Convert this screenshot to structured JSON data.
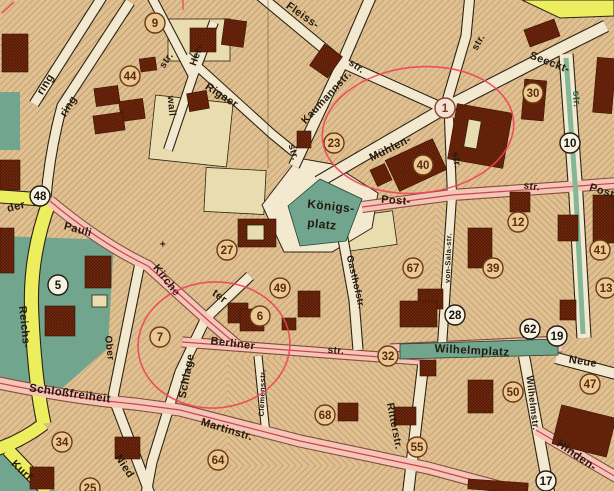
{
  "title": "Historical city map section with circled numbers and red ellipse annotations",
  "map": {
    "size": [
      614,
      491
    ],
    "palette": {
      "block": "#dfc092",
      "hatch": "#ad7b42",
      "ink": "#241a0e",
      "roadCream": "#f3e8d0",
      "roadCasing": "#2b2315",
      "roadPink": "#f2c6b8",
      "pinkCasing": "#8a4a3a",
      "redline": "#cf4348",
      "roadYellow": "#edee5f",
      "park": "#72a58d",
      "parkLine": "#1f4435",
      "median": "#84b795",
      "cream": "#e9dcae",
      "bld": "#7b2d11",
      "bldline": "#4e1703",
      "bldStroke": "#3a1403",
      "anno": "#ee4256",
      "greenText": "#1d5c3c",
      "foldLine": "#41351f"
    },
    "hatch2_zones": [
      {
        "x": 436,
        "y": 190,
        "w": 140,
        "h": 150
      },
      {
        "x": 228,
        "y": 358,
        "w": 202,
        "h": 108
      }
    ],
    "teal_early": [
      {
        "pts": "0,236 114,240 108,348 58,392 0,384"
      },
      {
        "pts": "0,92 20,92 20,150 0,150"
      },
      {
        "pts": "0,449 56,491 0,491"
      }
    ],
    "khaki": [
      {
        "x": 168,
        "y": 19,
        "w": 62,
        "h": 42,
        "rot": 0
      },
      {
        "x": 152,
        "y": 99,
        "w": 78,
        "h": 64,
        "rot": 6
      },
      {
        "x": 205,
        "y": 169,
        "w": 60,
        "h": 44,
        "rot": 3
      },
      {
        "x": 345,
        "y": 214,
        "w": 50,
        "h": 34,
        "rot": -8
      }
    ],
    "platz_poly": "262,205 298,158 332,164 378,193 372,228 332,252 284,252",
    "roads": [
      {
        "d": "M104,-6 L34,104",
        "w": 9,
        "k": "c"
      },
      {
        "d": "M130,2 L62,106 Q50,150 46,197",
        "w": 9,
        "k": "c"
      },
      {
        "d": "M150,-6 L193,76",
        "w": 8,
        "k": "c"
      },
      {
        "d": "M214,22 L193,76 L168,150",
        "w": 8,
        "k": "c"
      },
      {
        "d": "M186,56 L272,134 L294,152",
        "w": 8,
        "k": "c"
      },
      {
        "d": "M294,166 L340,68 L372,-6",
        "w": 10,
        "k": "c"
      },
      {
        "d": "M258,-6 L340,62 L445,109",
        "w": 9,
        "k": "c"
      },
      {
        "d": "M318,182 L445,108 L558,50 L606,26",
        "w": 11,
        "k": "c"
      },
      {
        "d": "M445,108 L466,36 L470,-6",
        "w": 9,
        "k": "c"
      },
      {
        "d": "M449,118 L452,196 L442,346",
        "w": 8,
        "k": "c"
      },
      {
        "d": "M566,54 L576,196 L584,338",
        "w": 13,
        "k": "c"
      },
      {
        "d": "M342,233 L354,300 L358,350",
        "w": 9,
        "k": "c"
      },
      {
        "d": "M250,276 L206,318 L180,372 L152,462 L146,494",
        "w": 9,
        "k": "c"
      },
      {
        "d": "M141,258 L113,397 L150,494",
        "w": 9,
        "k": "c"
      },
      {
        "d": "M258,356 L266,434",
        "w": 7,
        "k": "c"
      },
      {
        "d": "M424,358 L408,494",
        "w": 10,
        "k": "c"
      },
      {
        "d": "M524,356 L549,492",
        "w": 10,
        "k": "c"
      },
      {
        "d": "M556,358 L616,374",
        "w": 10,
        "k": "c"
      },
      {
        "d": "M-6,196 L50,200",
        "w": 12,
        "k": "y"
      },
      {
        "d": "M50,200 Q28,258 32,318 Q35,382 44,424",
        "w": 13,
        "k": "y"
      },
      {
        "d": "M44,424 Q20,442 -6,450",
        "w": 12,
        "k": "y"
      },
      {
        "d": "M8,450 L48,492",
        "w": 12,
        "k": "y"
      },
      {
        "d": "M362,207 L452,195 L566,187 L618,183",
        "w": 10,
        "k": "p"
      },
      {
        "d": "M50,201 Q100,243 148,266 L210,322 L238,346",
        "w": 10,
        "k": "p"
      },
      {
        "d": "M182,342 L340,354 L434,361",
        "w": 9,
        "k": "p"
      },
      {
        "d": "M-6,382 Q70,398 135,404 L180,410 L300,441 L428,468 L525,494",
        "w": 11,
        "k": "p"
      },
      {
        "d": "M536,430 L618,478",
        "w": 10,
        "k": "p"
      },
      {
        "d": "M390,352 L562,344",
        "w": 15,
        "k": "p"
      }
    ],
    "median": {
      "d": "M566,58 L576,196 L583,334",
      "w": 5
    },
    "teal_late": [
      {
        "pts": "288,206 320,179 362,199 346,241 300,246"
      },
      {
        "pts": "400,344 558,339 558,355 400,359"
      }
    ],
    "buildings": [
      {
        "x": 2,
        "y": 34,
        "w": 26,
        "h": 38,
        "rot": 0,
        "kind": "d"
      },
      {
        "x": 0,
        "y": 160,
        "w": 20,
        "h": 30,
        "rot": 0,
        "kind": "d"
      },
      {
        "x": 0,
        "y": 228,
        "w": 14,
        "h": 45,
        "rot": 0,
        "kind": "d"
      },
      {
        "x": 95,
        "y": 87,
        "w": 24,
        "h": 18,
        "rot": -8,
        "kind": "d"
      },
      {
        "x": 120,
        "y": 100,
        "w": 24,
        "h": 20,
        "rot": -8,
        "kind": "d"
      },
      {
        "x": 94,
        "y": 114,
        "w": 30,
        "h": 18,
        "rot": -8,
        "kind": "d"
      },
      {
        "x": 140,
        "y": 58,
        "w": 16,
        "h": 13,
        "rot": -8,
        "kind": "d"
      },
      {
        "x": 190,
        "y": 28,
        "w": 26,
        "h": 24,
        "rot": 0,
        "kind": "d"
      },
      {
        "x": 223,
        "y": 20,
        "w": 22,
        "h": 26,
        "rot": 8,
        "kind": "d"
      },
      {
        "x": 188,
        "y": 92,
        "w": 20,
        "h": 18,
        "rot": -10,
        "kind": "d"
      },
      {
        "x": 315,
        "y": 48,
        "w": 22,
        "h": 26,
        "rot": 35,
        "kind": "d"
      },
      {
        "x": 526,
        "y": 24,
        "w": 32,
        "h": 18,
        "rot": -20,
        "kind": "d"
      },
      {
        "x": 595,
        "y": 58,
        "w": 19,
        "h": 55,
        "rot": 5,
        "kind": "d"
      },
      {
        "x": 523,
        "y": 80,
        "w": 22,
        "h": 40,
        "rot": 5,
        "kind": "d"
      },
      {
        "x": 452,
        "y": 108,
        "w": 56,
        "h": 56,
        "rot": 10,
        "kind": "d"
      },
      {
        "x": 466,
        "y": 120,
        "w": 13,
        "h": 28,
        "rot": 10,
        "kind": "c"
      },
      {
        "x": 390,
        "y": 148,
        "w": 52,
        "h": 34,
        "rot": -25,
        "kind": "d"
      },
      {
        "x": 373,
        "y": 166,
        "w": 16,
        "h": 18,
        "rot": -25,
        "kind": "d"
      },
      {
        "x": 297,
        "y": 131,
        "w": 14,
        "h": 17,
        "rot": 0,
        "kind": "d"
      },
      {
        "x": 510,
        "y": 192,
        "w": 20,
        "h": 20,
        "rot": 0,
        "kind": "d"
      },
      {
        "x": 558,
        "y": 215,
        "w": 20,
        "h": 26,
        "rot": 0,
        "kind": "d"
      },
      {
        "x": 468,
        "y": 228,
        "w": 24,
        "h": 40,
        "rot": 0,
        "kind": "d"
      },
      {
        "x": 593,
        "y": 195,
        "w": 21,
        "h": 48,
        "rot": 0,
        "kind": "d"
      },
      {
        "x": 418,
        "y": 289,
        "w": 25,
        "h": 20,
        "rot": 0,
        "kind": "d"
      },
      {
        "x": 400,
        "y": 301,
        "w": 37,
        "h": 26,
        "rot": 0,
        "kind": "d"
      },
      {
        "x": 560,
        "y": 300,
        "w": 16,
        "h": 20,
        "rot": 0,
        "kind": "d"
      },
      {
        "x": 85,
        "y": 256,
        "w": 26,
        "h": 32,
        "rot": 0,
        "kind": "d"
      },
      {
        "x": 45,
        "y": 306,
        "w": 30,
        "h": 30,
        "rot": 0,
        "kind": "d"
      },
      {
        "x": 92,
        "y": 295,
        "w": 15,
        "h": 12,
        "rot": 0,
        "kind": "c"
      },
      {
        "x": 238,
        "y": 219,
        "w": 38,
        "h": 28,
        "rot": 0,
        "kind": "d"
      },
      {
        "x": 247,
        "y": 225,
        "w": 17,
        "h": 15,
        "rot": 0,
        "kind": "c"
      },
      {
        "x": 228,
        "y": 303,
        "w": 20,
        "h": 20,
        "rot": 0,
        "kind": "d"
      },
      {
        "x": 240,
        "y": 309,
        "w": 24,
        "h": 22,
        "rot": 0,
        "kind": "d"
      },
      {
        "x": 282,
        "y": 318,
        "w": 14,
        "h": 12,
        "rot": 0,
        "kind": "d"
      },
      {
        "x": 298,
        "y": 291,
        "w": 22,
        "h": 26,
        "rot": 0,
        "kind": "d"
      },
      {
        "x": 556,
        "y": 411,
        "w": 56,
        "h": 40,
        "rot": 14,
        "kind": "d"
      },
      {
        "x": 468,
        "y": 380,
        "w": 25,
        "h": 33,
        "rot": 0,
        "kind": "d"
      },
      {
        "x": 420,
        "y": 360,
        "w": 16,
        "h": 16,
        "rot": 0,
        "kind": "d"
      },
      {
        "x": 394,
        "y": 407,
        "w": 22,
        "h": 18,
        "rot": 0,
        "kind": "d"
      },
      {
        "x": 30,
        "y": 467,
        "w": 24,
        "h": 22,
        "rot": 0,
        "kind": "d"
      },
      {
        "x": 115,
        "y": 437,
        "w": 25,
        "h": 22,
        "rot": 0,
        "kind": "d"
      },
      {
        "x": 338,
        "y": 403,
        "w": 20,
        "h": 18,
        "rot": 0,
        "kind": "d"
      },
      {
        "x": 468,
        "y": 481,
        "w": 60,
        "h": 10,
        "rot": 4,
        "kind": "d"
      }
    ],
    "fold_line": {
      "x": 268,
      "y1": 0,
      "y2": 168
    },
    "labels": [
      {
        "t": "ring",
        "x": 45,
        "y": 84,
        "r": -58
      },
      {
        "t": "ring",
        "x": 68,
        "y": 106,
        "r": -58
      },
      {
        "t": "str.",
        "x": 166,
        "y": 60,
        "r": -55,
        "s": 10
      },
      {
        "t": "Her-",
        "x": 196,
        "y": 55,
        "r": -70,
        "s": 10
      },
      {
        "t": "wall",
        "x": 172,
        "y": 106,
        "r": 85,
        "s": 10
      },
      {
        "t": "Rigaer",
        "x": 222,
        "y": 95,
        "r": 33
      },
      {
        "t": "Fleiss-",
        "x": 303,
        "y": 15,
        "r": 35
      },
      {
        "t": "str.",
        "x": 357,
        "y": 66,
        "r": 35,
        "s": 10
      },
      {
        "t": "Kaumannstr.",
        "x": 326,
        "y": 97,
        "r": -47,
        "s": 10.5
      },
      {
        "t": "str.",
        "x": 478,
        "y": 42,
        "r": -60,
        "s": 10
      },
      {
        "t": "Seeckt-",
        "x": 550,
        "y": 62,
        "r": 21
      },
      {
        "t": "str.",
        "x": 577,
        "y": 99,
        "r": 87,
        "s": 10,
        "c": "#1d5c3c"
      },
      {
        "t": "str.",
        "x": 294,
        "y": 152,
        "r": 75,
        "s": 10
      },
      {
        "t": "Mühlen-",
        "x": 390,
        "y": 148,
        "r": -26
      },
      {
        "t": "str.",
        "x": 457,
        "y": 160,
        "r": 80,
        "s": 10
      },
      {
        "t": "Königs-",
        "x": 331,
        "y": 206,
        "r": 6,
        "s": 12
      },
      {
        "t": "platz",
        "x": 322,
        "y": 224,
        "r": 6,
        "s": 12
      },
      {
        "t": "Post-",
        "x": 396,
        "y": 200,
        "r": 4
      },
      {
        "t": "str.",
        "x": 532,
        "y": 186,
        "r": 8,
        "s": 10
      },
      {
        "t": "Post-",
        "x": 604,
        "y": 191,
        "r": 18
      },
      {
        "t": "der",
        "x": 16,
        "y": 206,
        "r": -14
      },
      {
        "t": "Pauli",
        "x": 78,
        "y": 229,
        "r": 15
      },
      {
        "t": "Kirche",
        "x": 167,
        "y": 280,
        "r": 52
      },
      {
        "t": "ter",
        "x": 220,
        "y": 296,
        "r": 36
      },
      {
        "t": "Reichs-",
        "x": 25,
        "y": 327,
        "r": 84
      },
      {
        "t": "Ober",
        "x": 110,
        "y": 348,
        "r": 83,
        "s": 10
      },
      {
        "t": "Gasthofstr.",
        "x": 356,
        "y": 282,
        "r": 77,
        "s": 9.5
      },
      {
        "t": "Berliner",
        "x": 233,
        "y": 343,
        "r": 7
      },
      {
        "t": "str.",
        "x": 336,
        "y": 350,
        "r": 4,
        "s": 10
      },
      {
        "t": "Schlage",
        "x": 186,
        "y": 376,
        "r": -79
      },
      {
        "t": "Schloßfreiheit",
        "x": 70,
        "y": 393,
        "r": 8,
        "s": 11.5
      },
      {
        "t": "Martinstr.",
        "x": 227,
        "y": 429,
        "r": 17
      },
      {
        "t": "Clemensstr.",
        "x": 262,
        "y": 393,
        "r": -88,
        "s": 7.5
      },
      {
        "t": "von-Sala-str.",
        "x": 448,
        "y": 258,
        "r": -88,
        "s": 7.5
      },
      {
        "t": "Nied",
        "x": 125,
        "y": 466,
        "r": 57
      },
      {
        "t": "Kurf",
        "x": 22,
        "y": 470,
        "r": 44
      },
      {
        "t": "Ritterstr.",
        "x": 395,
        "y": 426,
        "r": 79,
        "s": 10.5
      },
      {
        "t": "Wilhelmplatz",
        "x": 472,
        "y": 350,
        "r": 3,
        "s": 11.5
      },
      {
        "t": "Neue",
        "x": 583,
        "y": 361,
        "r": 9
      },
      {
        "t": "Wilhelmstr.",
        "x": 533,
        "y": 403,
        "r": 83,
        "s": 9.5
      },
      {
        "t": "Hinden-",
        "x": 577,
        "y": 455,
        "r": 35,
        "s": 11.5
      },
      {
        "t": "+",
        "x": 163,
        "y": 244,
        "r": 0,
        "s": 10
      }
    ],
    "circles": [
      {
        "n": "9",
        "x": 155,
        "y": 23,
        "st": "b"
      },
      {
        "n": "44",
        "x": 130,
        "y": 76,
        "st": "b"
      },
      {
        "n": "30",
        "x": 533,
        "y": 93,
        "st": "b"
      },
      {
        "n": "1",
        "x": 445,
        "y": 108,
        "st": "l"
      },
      {
        "n": "10",
        "x": 570,
        "y": 143,
        "st": "w"
      },
      {
        "n": "23",
        "x": 334,
        "y": 143,
        "st": "b"
      },
      {
        "n": "40",
        "x": 423,
        "y": 165,
        "st": "b"
      },
      {
        "n": "48",
        "x": 40,
        "y": 196,
        "st": "w"
      },
      {
        "n": "12",
        "x": 518,
        "y": 222,
        "st": "b"
      },
      {
        "n": "27",
        "x": 227,
        "y": 250,
        "st": "b"
      },
      {
        "n": "41",
        "x": 600,
        "y": 250,
        "st": "b"
      },
      {
        "n": "67",
        "x": 413,
        "y": 268,
        "st": "b"
      },
      {
        "n": "39",
        "x": 493,
        "y": 268,
        "st": "b"
      },
      {
        "n": "5",
        "x": 58,
        "y": 285,
        "st": "w"
      },
      {
        "n": "13",
        "x": 606,
        "y": 288,
        "st": "b"
      },
      {
        "n": "49",
        "x": 280,
        "y": 288,
        "st": "b"
      },
      {
        "n": "28",
        "x": 455,
        "y": 315,
        "st": "w"
      },
      {
        "n": "6",
        "x": 260,
        "y": 316,
        "st": "b"
      },
      {
        "n": "62",
        "x": 530,
        "y": 329,
        "st": "w"
      },
      {
        "n": "19",
        "x": 557,
        "y": 336,
        "st": "w"
      },
      {
        "n": "7",
        "x": 160,
        "y": 337,
        "st": "b"
      },
      {
        "n": "32",
        "x": 388,
        "y": 356,
        "st": "b"
      },
      {
        "n": "47",
        "x": 590,
        "y": 384,
        "st": "b"
      },
      {
        "n": "50",
        "x": 513,
        "y": 392,
        "st": "b"
      },
      {
        "n": "68",
        "x": 325,
        "y": 415,
        "st": "b"
      },
      {
        "n": "34",
        "x": 62,
        "y": 442,
        "st": "b"
      },
      {
        "n": "55",
        "x": 417,
        "y": 447,
        "st": "b"
      },
      {
        "n": "64",
        "x": 218,
        "y": 460,
        "st": "b"
      },
      {
        "n": "17",
        "x": 546,
        "y": 481,
        "st": "w"
      },
      {
        "n": "25",
        "x": 90,
        "y": 488,
        "st": "b"
      }
    ],
    "annotations": [
      {
        "cx": 418,
        "cy": 130,
        "rx": 96,
        "ry": 63,
        "rot": -6
      },
      {
        "cx": 214,
        "cy": 345,
        "rx": 76,
        "ry": 63,
        "rot": -3
      }
    ],
    "reg_marks": [
      "M2,13 L14,2",
      "M183,0 L183,10"
    ],
    "corner_patch": "522,0 614,0 614,16 560,18"
  }
}
